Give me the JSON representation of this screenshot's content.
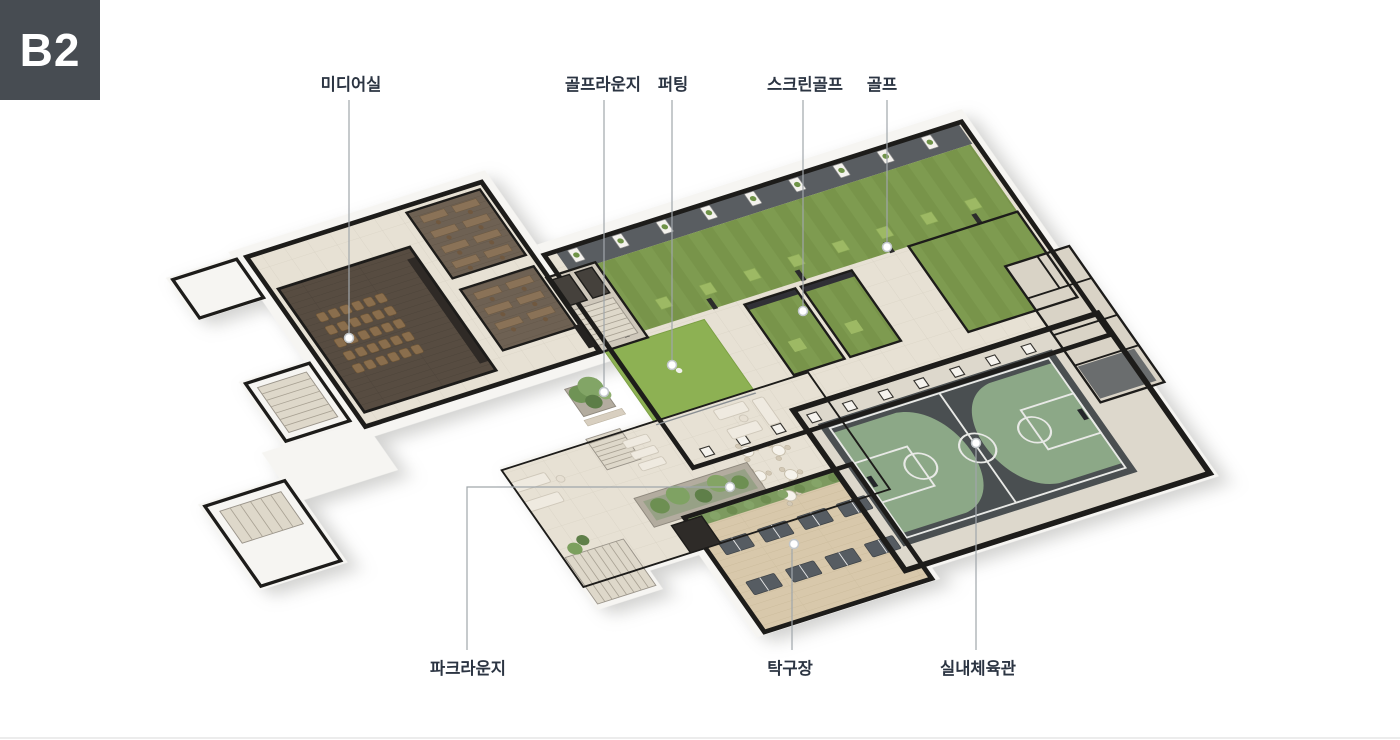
{
  "badge": {
    "label": "B2"
  },
  "floorplan": {
    "type": "isometric-floorplan",
    "areas": [
      {
        "id": "media-room",
        "label": "미디어실"
      },
      {
        "id": "golf-lounge",
        "label": "골프라운지"
      },
      {
        "id": "putting",
        "label": "퍼팅"
      },
      {
        "id": "screen-golf",
        "label": "스크린골프"
      },
      {
        "id": "golf",
        "label": "골프"
      },
      {
        "id": "park-lounge",
        "label": "파크라운지"
      },
      {
        "id": "table-tennis",
        "label": "탁구장"
      },
      {
        "id": "gymnasium",
        "label": "실내체육관"
      }
    ],
    "colors": {
      "badge_bg": "#474c52",
      "label_text": "#2b3442",
      "leader_line": "#a0a6ab",
      "turf_green": "#7e9b50",
      "putting_green": "#8db153",
      "court_floor": "#4a4f51",
      "court_zone_green": "#8ca887",
      "wall": "#1d1c1a",
      "wood_floor": "#d8c8ab",
      "media_floor": "#574c41",
      "tile_floor": "#e7e1d4"
    }
  }
}
